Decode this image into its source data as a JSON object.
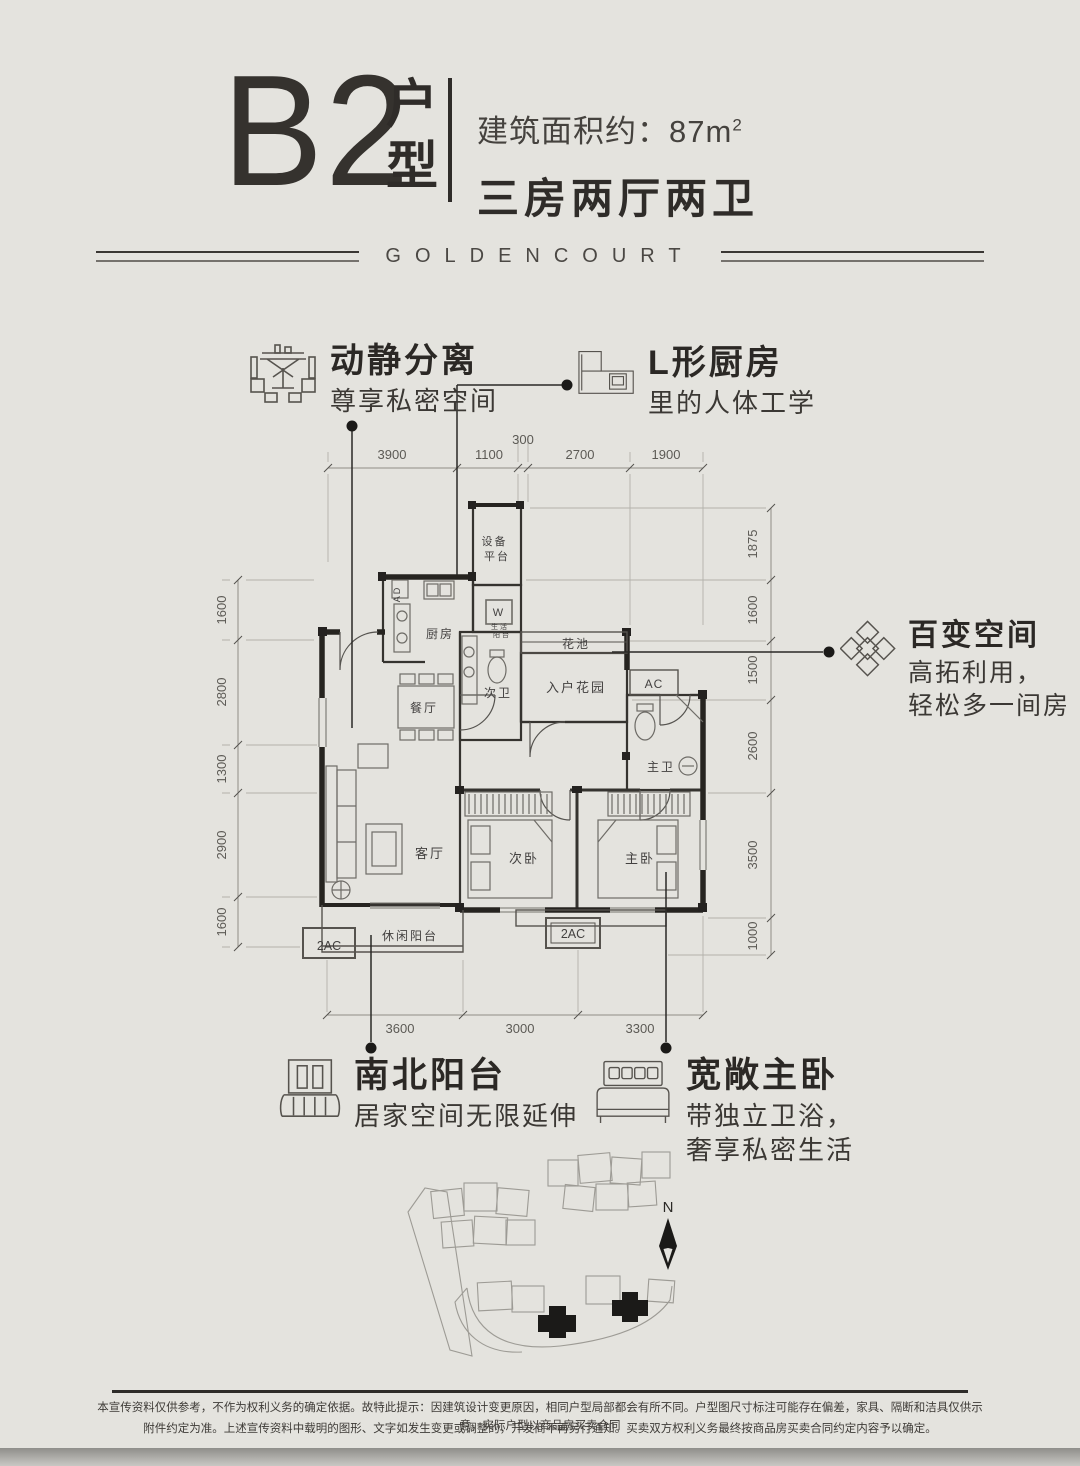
{
  "header": {
    "unit_code": "B2",
    "unit_suffix": "户型",
    "area_text": "建筑面积约：87m",
    "area_sup": "2",
    "layout_text": "三房两厅两卫"
  },
  "banner": {
    "brand": "GOLDENCOURT"
  },
  "callouts": {
    "quiet": {
      "title": "动静分离",
      "subtitle": "尊享私密空间"
    },
    "kitchen": {
      "title": "L形厨房",
      "subtitle": "里的人体工学"
    },
    "flex": {
      "title": "百变空间",
      "subtitle1": "高拓利用，",
      "subtitle2": "轻松多一间房"
    },
    "balcony": {
      "title": "南北阳台",
      "subtitle": "居家空间无限延伸"
    },
    "master": {
      "title": "宽敞主卧",
      "subtitle1": "带独立卫浴，",
      "subtitle2": "奢享私密生活"
    }
  },
  "plan": {
    "rooms": {
      "equipment1": "设备",
      "equipment2": "平台",
      "ad": "AD",
      "kitchen": "厨房",
      "washer": "W",
      "utility1": "生活",
      "utility2": "阳台",
      "flower_bed": "花池",
      "entry_garden": "入户花园",
      "ac": "AC",
      "bath2": "次卫",
      "dining": "餐厅",
      "bath1": "主卫",
      "living": "客厅",
      "bed2": "次卧",
      "bed1": "主卧",
      "leisure_balcony": "休闲阳台",
      "ac2_left": "2AC",
      "ac2_mid": "2AC"
    },
    "dims": {
      "top": [
        "3900",
        "1100",
        "300",
        "2700",
        "1900"
      ],
      "left": [
        "1600",
        "2800",
        "1300",
        "2900",
        "1600"
      ],
      "right": [
        "1875",
        "1600",
        "1500",
        "2600",
        "3500",
        "1000"
      ],
      "bottom": [
        "3600",
        "3000",
        "3300"
      ]
    }
  },
  "siteplan": {
    "north_label": "N"
  },
  "footer": {
    "line1": "本宣传资料仅供参考，不作为权利义务的确定依据。故特此提示：因建筑设计变更原因，相同户型局部都会有所不同。户型图尺寸标注可能存在偏差，家具、隔断和洁具仅供示意，实际户型以商品房买卖合同",
    "line2": "附件约定为准。上述宣传资料中载明的图形、文字如发生变更或调整的，开发商不再另行通知。买卖双方权利义务最终按商品房买卖合同约定内容予以确定。"
  },
  "colors": {
    "background": "#e4e3de",
    "ink": "#2b2926",
    "dim_line": "#8f8d87"
  }
}
